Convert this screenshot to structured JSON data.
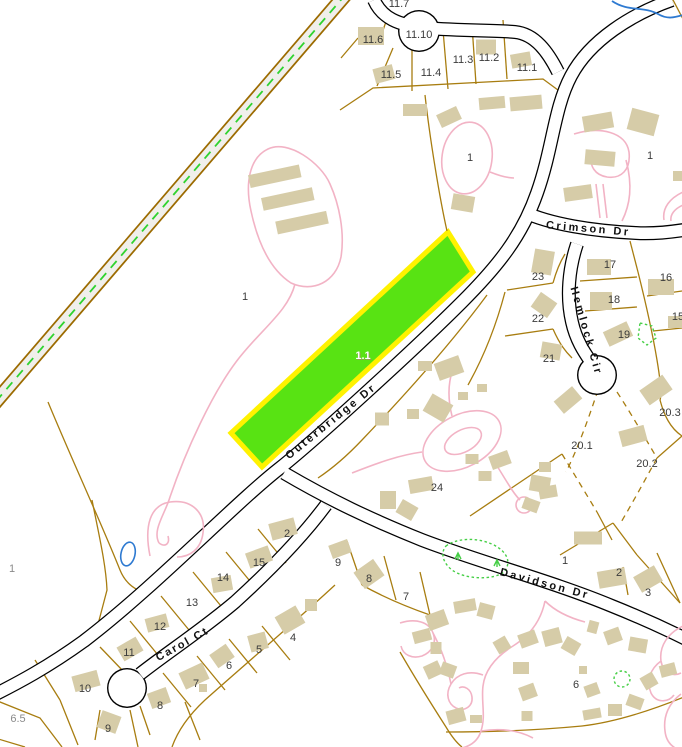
{
  "map": {
    "highlighted_parcel": {
      "id": "1.1",
      "fill": "#58e313",
      "outline": "#fff200"
    },
    "colors": {
      "parcel_line": "#a87d10",
      "building": "#d6cca8",
      "road_casing": "#000000",
      "road_fill": "#ffffff",
      "driveway_pink": "#f2b3c5",
      "trail_edge": "#9c6b00",
      "trail_fill": "#f0efeb",
      "trail_dash_green": "#2fd32f",
      "water_blue": "#2e7ad1",
      "wetland_green": "#46cf46",
      "label_dark": "#3b3b3b",
      "label_gray": "#8a8a8a"
    },
    "road_labels": [
      {
        "text": "Crimson Dr",
        "x": 588,
        "y": 232,
        "rot": 5,
        "ls": 2.5
      },
      {
        "text": "Hemlock Cir",
        "x": 583,
        "y": 332,
        "rot": 74,
        "ls": 2.5
      },
      {
        "text": "Outerbridge Dr",
        "x": 333,
        "y": 424,
        "rot": -39,
        "ls": 2.5
      },
      {
        "text": "Davidson Dr",
        "x": 544,
        "y": 587,
        "rot": 15,
        "ls": 2.5
      },
      {
        "text": "Carol Ct",
        "x": 184,
        "y": 647,
        "rot": -29,
        "ls": 2
      }
    ],
    "parcel_labels": [
      {
        "text": "11.7",
        "x": 399,
        "y": 3
      },
      {
        "text": "11.6",
        "x": 373,
        "y": 39
      },
      {
        "text": "11.10",
        "x": 419,
        "y": 34
      },
      {
        "text": "11.5",
        "x": 391,
        "y": 74
      },
      {
        "text": "11.4",
        "x": 431,
        "y": 72
      },
      {
        "text": "11.3",
        "x": 463,
        "y": 59
      },
      {
        "text": "11.2",
        "x": 489,
        "y": 57
      },
      {
        "text": "11.1",
        "x": 527,
        "y": 67
      },
      {
        "text": "1",
        "x": 470,
        "y": 157
      },
      {
        "text": "1",
        "x": 245,
        "y": 296
      },
      {
        "text": "23",
        "x": 538,
        "y": 276
      },
      {
        "text": "17",
        "x": 610,
        "y": 264
      },
      {
        "text": "16",
        "x": 666,
        "y": 277
      },
      {
        "text": "18",
        "x": 614,
        "y": 299
      },
      {
        "text": "22",
        "x": 538,
        "y": 318
      },
      {
        "text": "19",
        "x": 624,
        "y": 334
      },
      {
        "text": "15",
        "x": 678,
        "y": 316
      },
      {
        "text": "21",
        "x": 549,
        "y": 358
      },
      {
        "text": "20.3",
        "x": 670,
        "y": 412
      },
      {
        "text": "20.1",
        "x": 582,
        "y": 445
      },
      {
        "text": "20.2",
        "x": 647,
        "y": 463
      },
      {
        "text": "24",
        "x": 437,
        "y": 487
      },
      {
        "text": "1",
        "x": 565,
        "y": 560
      },
      {
        "text": "2",
        "x": 619,
        "y": 572
      },
      {
        "text": "3",
        "x": 648,
        "y": 592
      },
      {
        "text": "7",
        "x": 406,
        "y": 596
      },
      {
        "text": "9",
        "x": 338,
        "y": 562
      },
      {
        "text": "8",
        "x": 369,
        "y": 578
      },
      {
        "text": "2",
        "x": 287,
        "y": 533
      },
      {
        "text": "15",
        "x": 259,
        "y": 562
      },
      {
        "text": "14",
        "x": 223,
        "y": 577
      },
      {
        "text": "13",
        "x": 192,
        "y": 602
      },
      {
        "text": "12",
        "x": 160,
        "y": 626
      },
      {
        "text": "11",
        "x": 129,
        "y": 652
      },
      {
        "text": "10",
        "x": 85,
        "y": 688
      },
      {
        "text": "9",
        "x": 108,
        "y": 728
      },
      {
        "text": "8",
        "x": 160,
        "y": 705
      },
      {
        "text": "7",
        "x": 196,
        "y": 683
      },
      {
        "text": "6",
        "x": 229,
        "y": 665
      },
      {
        "text": "5",
        "x": 259,
        "y": 649
      },
      {
        "text": "4",
        "x": 293,
        "y": 637
      },
      {
        "text": "6",
        "x": 576,
        "y": 684
      },
      {
        "text": "1",
        "x": 650,
        "y": 155
      }
    ],
    "gray_labels": [
      {
        "text": "6.5",
        "x": 12,
        "y": 718
      },
      {
        "text": "1",
        "x": 6,
        "y": 568
      }
    ],
    "highlight_label": {
      "text": "1.1",
      "x": 363,
      "y": 359
    }
  }
}
